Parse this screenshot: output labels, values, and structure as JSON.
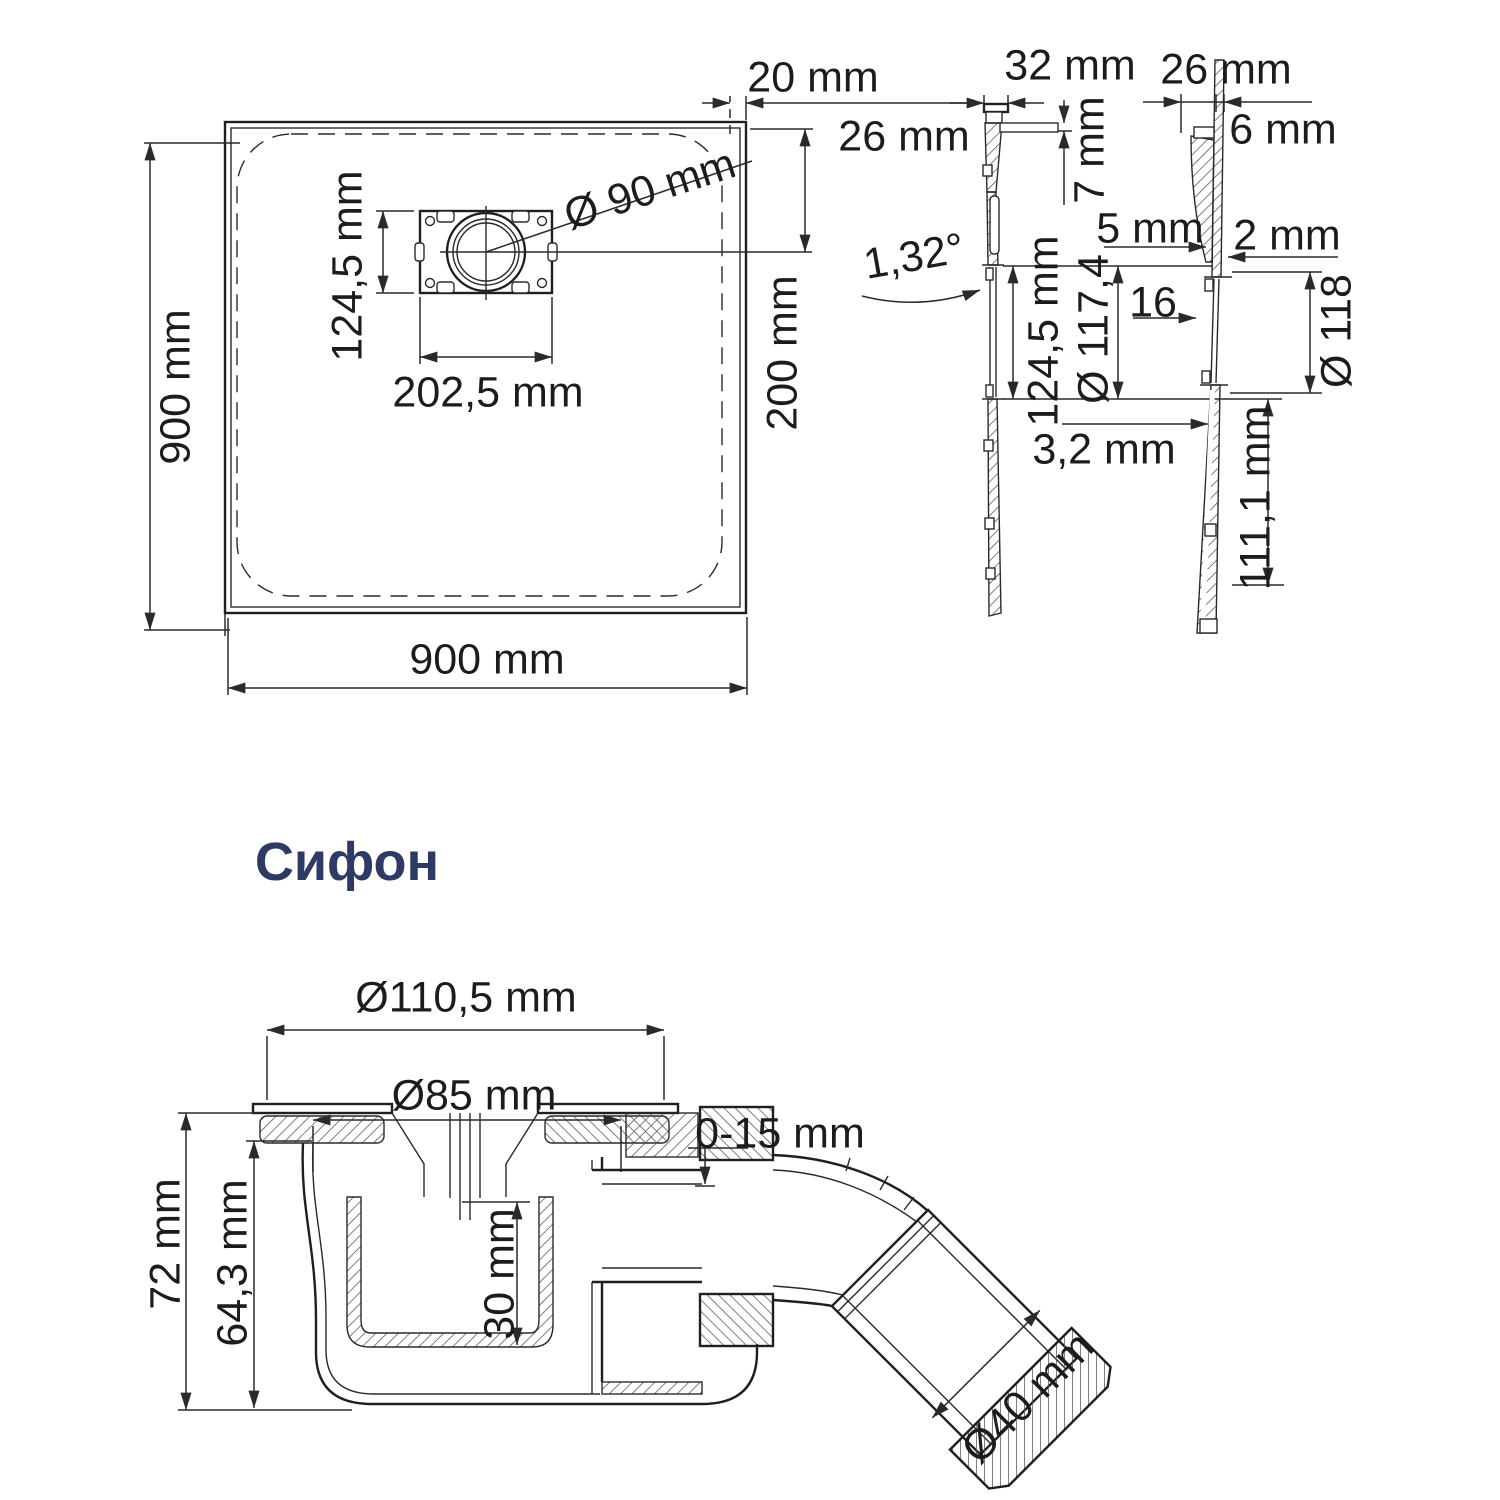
{
  "plan_view": {
    "side_height": "900 mm",
    "side_width": "900 mm",
    "drain_height": "124,5 mm",
    "drain_width": "202,5 mm",
    "drain_diameter": "Ø 90 mm",
    "edge_gap": "20 mm",
    "drain_center_distance": "200 mm"
  },
  "section_side": {
    "rim_width": "32 mm",
    "rim_height": "26 mm",
    "panel_thickness": "7 mm",
    "slope_angle": "1,32°",
    "drain_opening": "124,5 mm",
    "base_thickness": "3,2 mm"
  },
  "section_front": {
    "rim_width": "26 mm",
    "rim_thickness": "6 mm",
    "step_a": "5 mm",
    "step_b": "2 mm",
    "step_c": "16",
    "drain_bore": "Ø 117,4",
    "flange_diameter": "Ø 118",
    "lower_section": "111,1 mm"
  },
  "siphon": {
    "title": "Сифон",
    "flange_diameter": "Ø110,5 mm",
    "bowl_diameter": "Ø85 mm",
    "adjustment": "0-15 mm",
    "total_height": "72 mm",
    "body_height": "64,3 mm",
    "cup_depth": "30 mm",
    "outlet_diameter": "Ø40 mm"
  },
  "colors": {
    "line": "#1f1f1f",
    "dimension_text": "#1c1c1c",
    "heading": "#2e3a64"
  }
}
